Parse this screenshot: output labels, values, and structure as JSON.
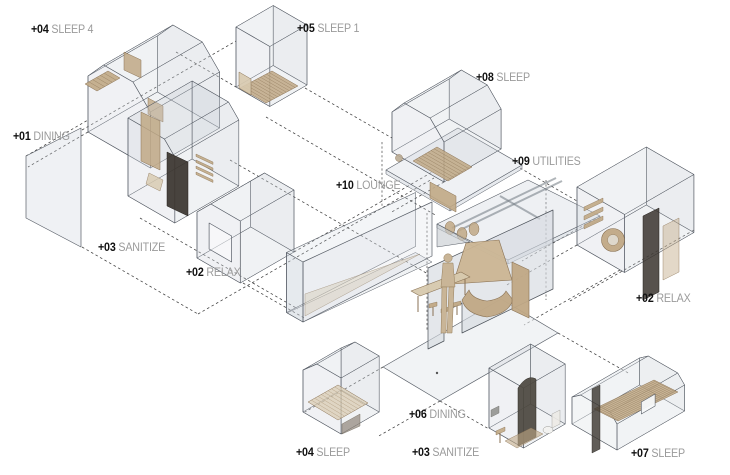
{
  "diagram_title": "Exploded axonometric module diagram",
  "labels": [
    {
      "id": "label-04-sleep4",
      "num": "+04",
      "name": "SLEEP 4"
    },
    {
      "id": "label-05-sleep1",
      "num": "+05",
      "name": "SLEEP 1"
    },
    {
      "id": "label-08-sleep",
      "num": "+08",
      "name": "SLEEP"
    },
    {
      "id": "label-01-dining",
      "num": "+01",
      "name": "DINING"
    },
    {
      "id": "label-09-utilities",
      "num": "+09",
      "name": "UTILITIES"
    },
    {
      "id": "label-10-lounge",
      "num": "+10",
      "name": "LOUNGE"
    },
    {
      "id": "label-03-sanitize-upper",
      "num": "+03",
      "name": "SANITIZE"
    },
    {
      "id": "label-02-relax-left",
      "num": "+02",
      "name": "RELAX"
    },
    {
      "id": "label-02-relax-right",
      "num": "+02",
      "name": "RELAX"
    },
    {
      "id": "label-06-dining",
      "num": "+06",
      "name": "DINING"
    },
    {
      "id": "label-04-sleep-bottom",
      "num": "+04",
      "name": "SLEEP"
    },
    {
      "id": "label-03-sanitize-bottom",
      "num": "+03",
      "name": "SANITIZE"
    },
    {
      "id": "label-07-sleep",
      "num": "+07",
      "name": "SLEEP"
    }
  ],
  "palette": {
    "background": "#ffffff",
    "label_number": "#111111",
    "label_name": "#9b9b9b",
    "glass_fill": "#c9d1d9",
    "glass_front_fill": "#d8dee4",
    "glass_stroke": "#575d66",
    "wood_fill": "#c0a885",
    "wood_light": "#d7c9ae",
    "wood_stroke": "#8a7254",
    "dark_panel": "#39342e",
    "dash_line": "#1c1c1c",
    "floor_fill": "#e7ebee"
  }
}
